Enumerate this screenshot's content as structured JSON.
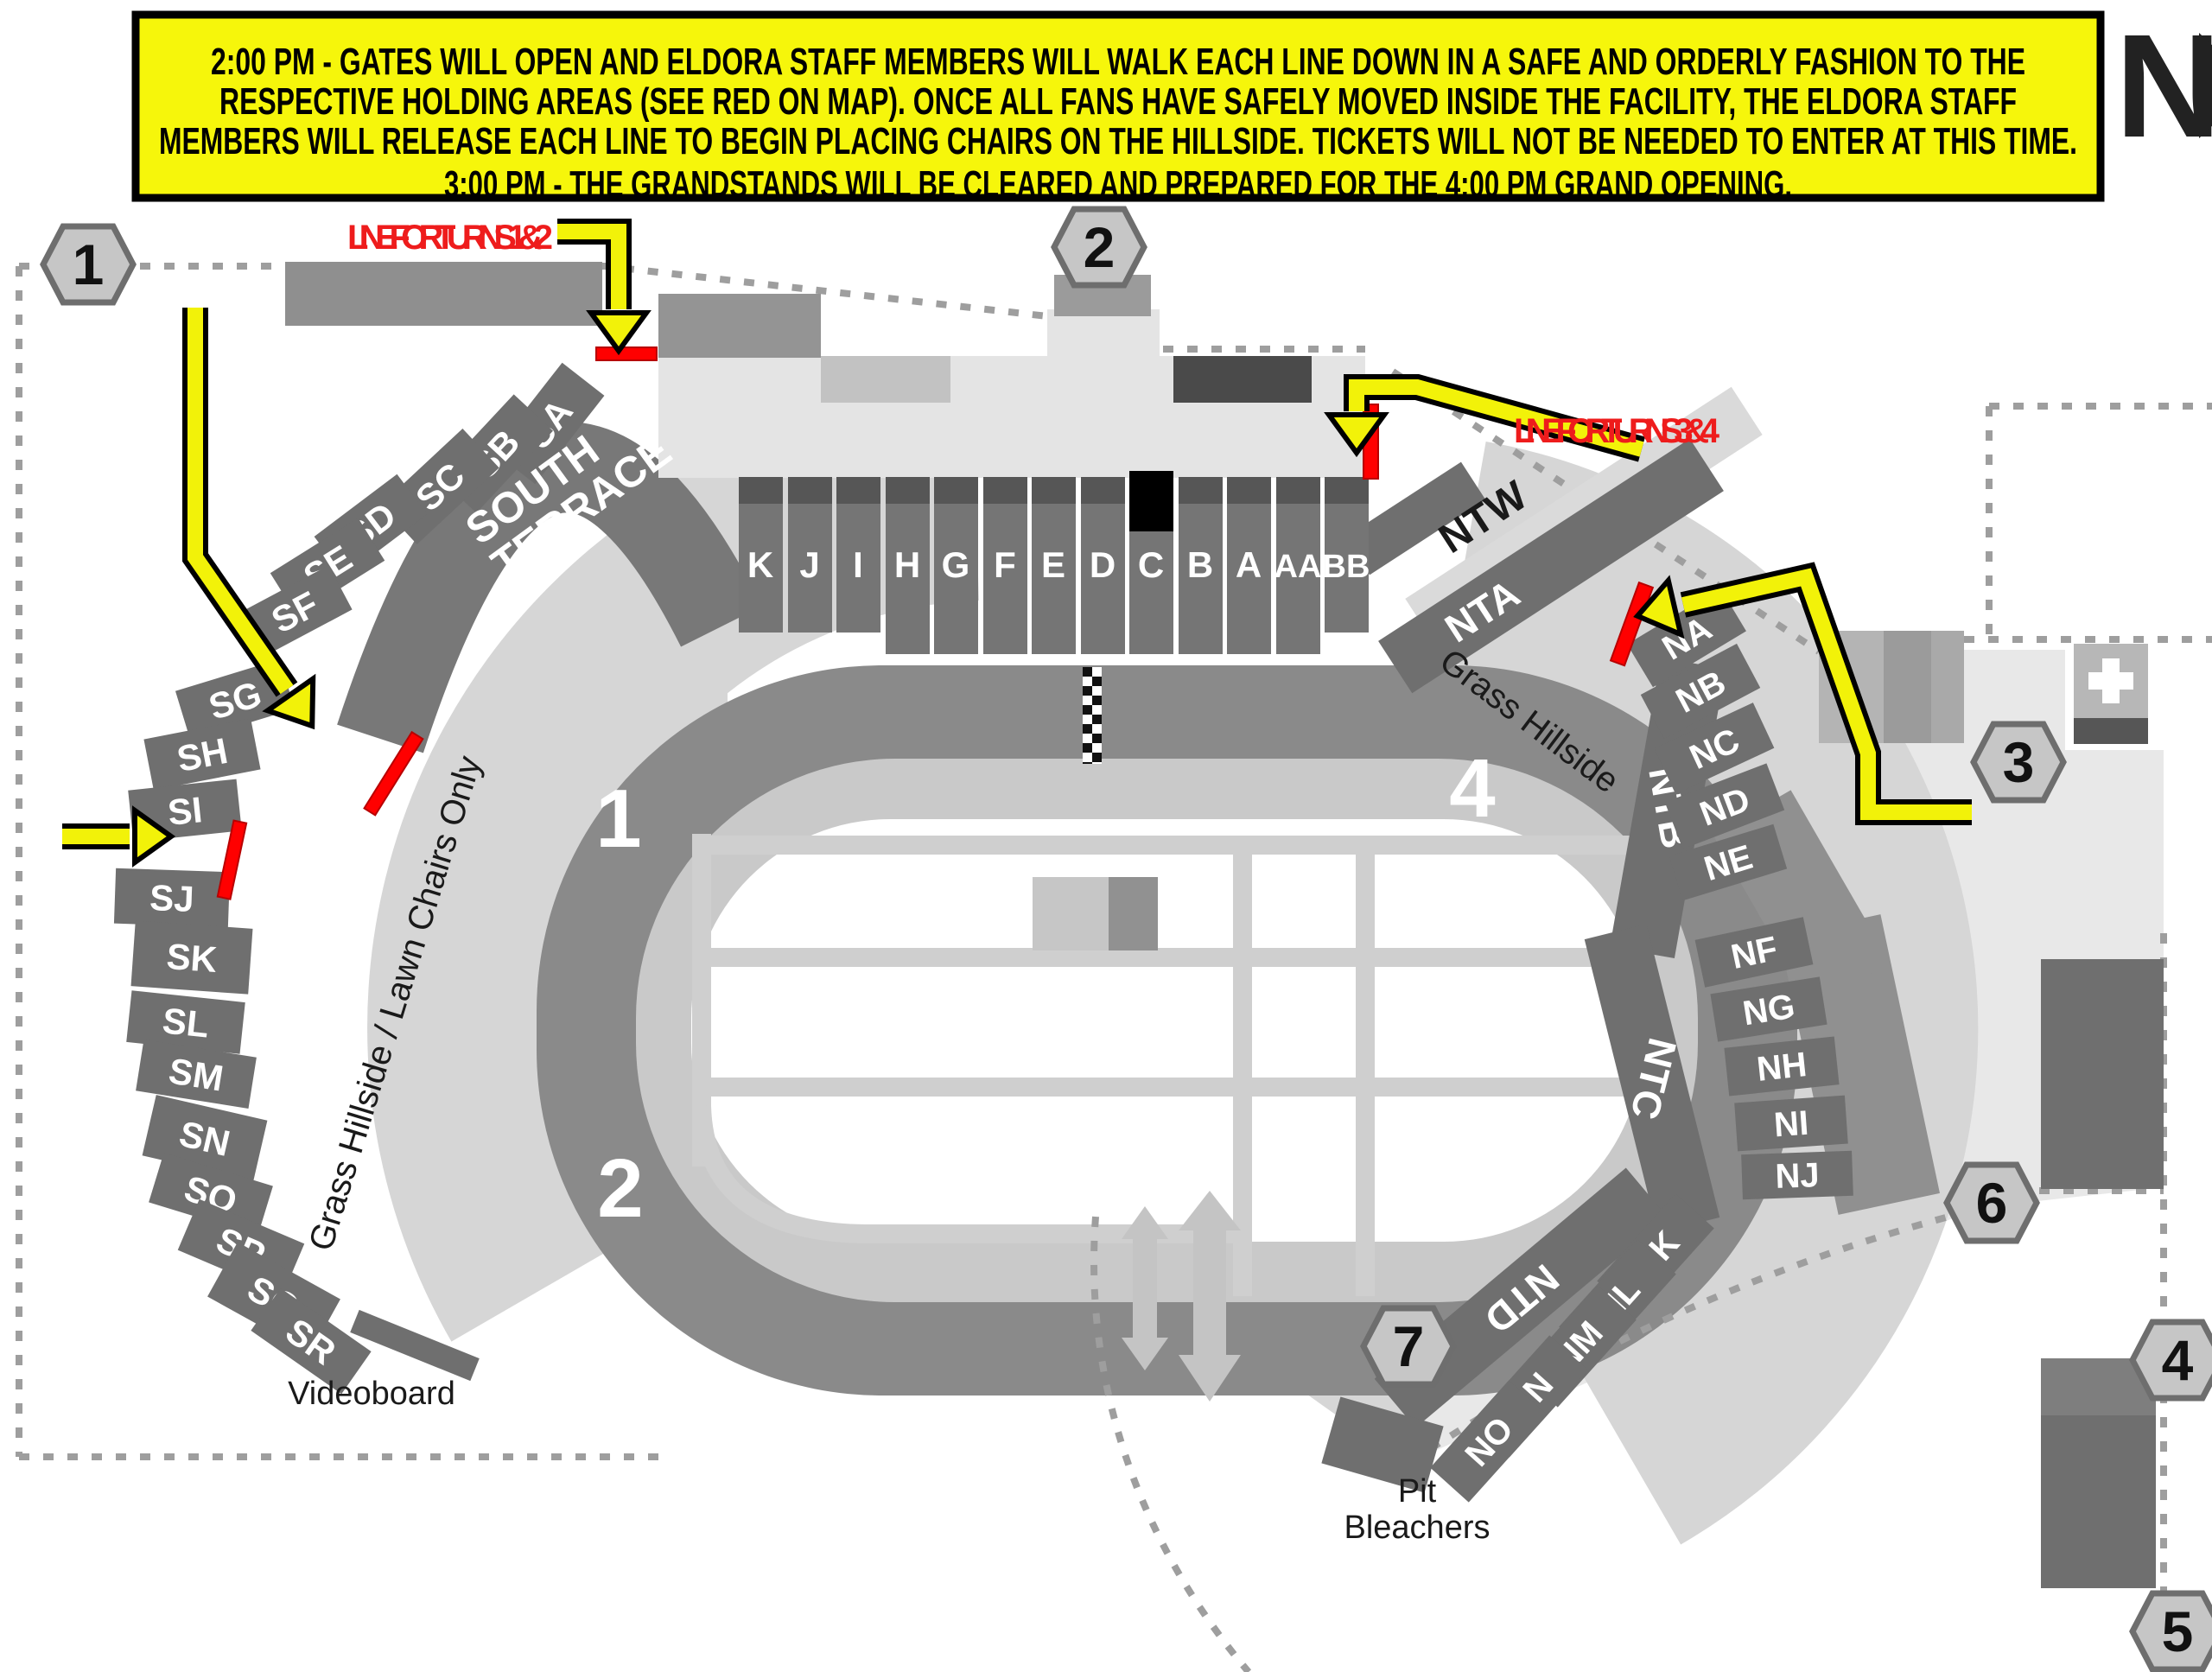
{
  "banner": {
    "bg_color": "#F6F60B",
    "border_color": "#000000",
    "lines": [
      "2:00 PM - GATES WILL OPEN AND ELDORA STAFF MEMBERS WILL WALK EACH LINE DOWN IN A SAFE AND ORDERLY FASHION TO THE",
      "RESPECTIVE HOLDING AREAS (SEE RED ON MAP). ONCE ALL FANS HAVE SAFELY MOVED INSIDE THE FACILITY, THE ELDORA STAFF",
      "MEMBERS WILL RELEASE EACH LINE TO BEGIN PLACING CHAIRS ON THE HILLSIDE. TICKETS WILL NOT BE NEEDED TO ENTER AT THIS TIME.",
      "3:00 PM - THE GRANDSTANDS WILL BE CLEARED AND PREPARED FOR THE 4:00 PM GRAND OPENING."
    ]
  },
  "north_indicator": {
    "letter": "N"
  },
  "annotations": {
    "line_turns_12": "LINE FOR TURNS 1 & 2",
    "line_turns_34": "LINE FOR TURNS 3 & 4",
    "text_red": "#EE1C1C",
    "holding_line_red": "#FF0000",
    "arrow_yellow": "#F2F209"
  },
  "gates": [
    "1",
    "2",
    "3",
    "4",
    "5",
    "6",
    "7"
  ],
  "track": {
    "turns": [
      "1",
      "2",
      "3",
      "4"
    ],
    "start_finish": "checkered-line"
  },
  "sections": {
    "south_terrace": {
      "line1": "SOUTH",
      "line2": "TERRACE"
    },
    "south_upper": [
      "SA",
      "SB",
      "SC",
      "SD",
      "SE",
      "SF",
      "SG",
      "SH",
      "SI"
    ],
    "south_lower": [
      "SJ",
      "SK",
      "SL",
      "SM",
      "SN",
      "SO",
      "SP",
      "SQ",
      "SR"
    ],
    "main_grandstand": [
      "K",
      "J",
      "I",
      "H",
      "G",
      "F",
      "E",
      "D",
      "C",
      "B",
      "A",
      "AA",
      "BB"
    ],
    "north_terraces": [
      "NTW",
      "NTA",
      "NTB",
      "NTC",
      "NTD"
    ],
    "north_upper": [
      "NA",
      "NB",
      "NC",
      "ND",
      "NE"
    ],
    "north_mid": [
      "NF",
      "NG",
      "NH",
      "NI",
      "NJ"
    ],
    "north_lower": [
      "NK",
      "NL",
      "NM",
      "NN",
      "NO"
    ]
  },
  "labels": {
    "grass_hillside_lawn": "Grass Hillside / Lawn Chairs Only",
    "grass_hillside": "Grass Hillside",
    "videoboard": "Videoboard",
    "pit_line1": "Pit",
    "pit_line2": "Bleachers",
    "first_aid": "+"
  },
  "colors": {
    "section_gray": "#6F6F6F",
    "track_gray": "#8A8A8A",
    "apron_gray": "#C9C9C9",
    "hillside_gray": "#D6D6D6",
    "concourse_gray": "#E4E4E4",
    "suite_dark": "#4A4A4A"
  }
}
